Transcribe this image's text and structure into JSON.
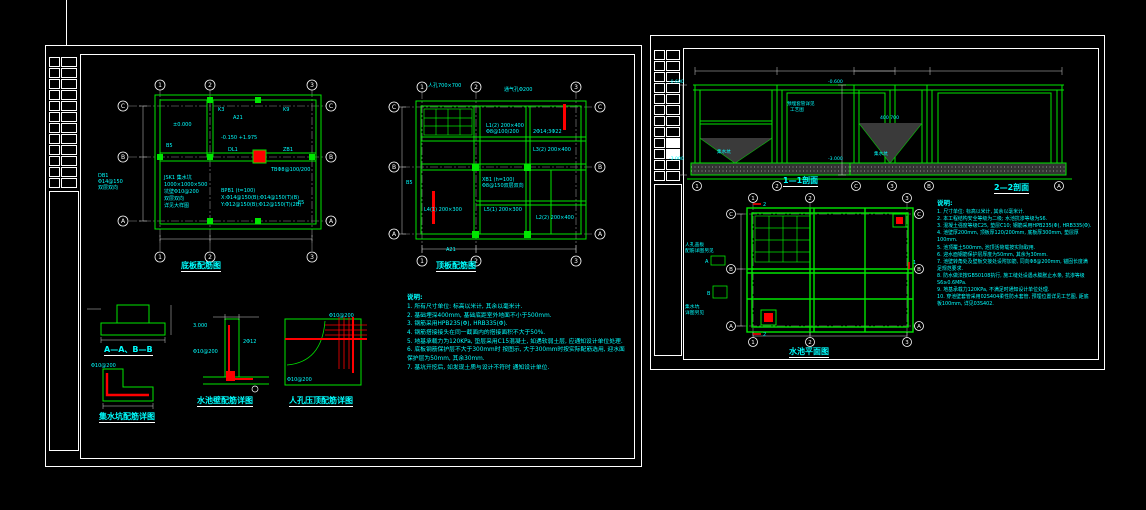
{
  "colors": {
    "background": "#000000",
    "line_green": "#00e600",
    "annotation_cyan": "#00ffff",
    "dimension_white": "#ffffff",
    "highlight_red": "#ff0000",
    "grid_gray": "#8f8f8f"
  },
  "left_sheet": {
    "plan1": {
      "title": "底板配筋图",
      "grid_cols": [
        "1",
        "2",
        "3"
      ],
      "grid_rows": [
        "C",
        "B",
        "A"
      ],
      "ann": {
        "lvl0": "±0.000",
        "lvl1": "-0.150  +1.975",
        "a21": "A21",
        "tb": "TBΦ8@100/200",
        "bpb": "BPB1 (t=100)",
        "bx": "X:Φ14@150(B);Φ14@150(T)(B)",
        "by": "Y:Φ12@150(B);Φ12@150(T)(2B)",
        "db1": "DB1",
        "db2": "Φ14@150",
        "db3": "双层双向",
        "jsk1": "JSK1 集水坑",
        "jsk2": "1000×1000×500",
        "jsk3": "坑壁Φ10@200",
        "jsk4": "双层双向",
        "jsk5": "详见大样图",
        "k3": "K3",
        "k9": "K9",
        "b5": "B5",
        "e5": "E5",
        "dl": "DL1",
        "zb": "ZB1"
      }
    },
    "plan2": {
      "title": "顶板配筋图",
      "grid_cols": [
        "1",
        "2",
        "3"
      ],
      "grid_rows": [
        "C",
        "B",
        "A"
      ],
      "ann": {
        "rk": "人孔700×700",
        "tq": "通气孔Φ200",
        "l1a": "L1(2) 200×400",
        "l1b": "Φ8@100/200",
        "l1c": "2Φ14;3Φ22",
        "l3": "L3(2) 200×400",
        "xb1": "XB1 (h=100)",
        "xb2": "Φ8@150双层双向",
        "l4": "L4(1) 200×300",
        "l5": "L5(1) 200×300",
        "l2": "L2(2) 200×400",
        "a21": "A21",
        "b5": "B5"
      }
    },
    "details": {
      "aab_title": "A—A、B—B",
      "pit_title": "集水坑配筋详图",
      "wall_title": "水池壁配筋详图",
      "corner_title": "人孔压顶配筋详图",
      "pit_ann": "Φ10@200",
      "wall_ann1": "Φ10@200",
      "wall_ann2": "2Φ12",
      "wall_lvl": "3.000",
      "corner_ann1": "Φ10@200",
      "corner_ann2": "Φ10@200"
    },
    "notes": {
      "heading": "说明:",
      "items": [
        "1. 所有尺寸单位: 标高以米计, 其余以毫米计.",
        "2. 基础埋深400mm, 基础底距室外地面不小于500mm.",
        "3. 钢筋采用HPB235(Φ), HRB335(Φ).",
        "4. 钢筋搭接接头在同一截面内的搭接面积不大于50%.",
        "5. 地基承载力为120KPa, 垫层采用C15混凝土, 如遇软弱土层, 应通知设计单位处理.",
        "6. 底板钢筋保护层不大于300mm时 按图示, 大于300mm时按实际配筋选用, 迎水面保护层为50mm, 其余30mm.",
        "7. 基坑开挖后, 如发现土质与设计不符时 通知设计单位."
      ]
    }
  },
  "right_sheet": {
    "sec11": {
      "title": "1—1剖面",
      "bubbles": [
        "1",
        "2",
        "3"
      ],
      "ann": {
        "lvl_top": "-0.600",
        "lvl_bot": "-3.000",
        "note1": "预埋套管详见",
        "note2": "工艺图",
        "pit": "集水坑"
      }
    },
    "sec22": {
      "title": "2—2剖面",
      "bubbles": [
        "C",
        "B",
        "A"
      ],
      "ann": {
        "lvl_top": "-0.600",
        "lvl_bot": "-3.000",
        "dim": "400  700",
        "pit": "集水坑"
      }
    },
    "plan": {
      "title": "水池平面图",
      "grid_cols": [
        "1",
        "2",
        "3"
      ],
      "grid_rows": [
        "C",
        "B",
        "A"
      ],
      "ann": {
        "mk1": "2",
        "mk2": "2",
        "mk3": "1",
        "rk1": "人孔盖板",
        "rk2": "配筋详图另见",
        "js1": "集水坑",
        "js2": "详图另见",
        "fa": "A",
        "fb": "B"
      }
    },
    "notes": {
      "heading": "说明:",
      "items": [
        "1. 尺寸单位: 标高以米计, 其余以毫米计.",
        "2. 本工程结构安全等级为二级; 水池抗渗等级为S6.",
        "3. 混凝土强度等级C25, 垫层C10; 钢筋采用HPB235(Φ), HRB335(Φ).",
        "4. 池壁厚200mm, 顶板厚120/200mm, 底板厚300mm, 垫层厚100mm.",
        "5. 池顶覆土500mm, 池顶活荷载按实际取用.",
        "6. 迎水面钢筋保护层厚度为50mm, 其余为30mm.",
        "7. 池壁转角处及壁板交接处设附加筋, 同向Φ8@200mm, 锚固长度满足规范要求.",
        "8. 防水做法按GB50108执行, 施工缝处设遇水膨胀止水条, 抗渗等级S6≥0.6MPa.",
        "9. 地基承载力120KPa, 不满足时通知设计单位处理.",
        "10. 穿池壁套管采用02S404柔性防水套管, 预埋位置详见工艺图, 距底板100mm, 详见03S402."
      ]
    }
  }
}
